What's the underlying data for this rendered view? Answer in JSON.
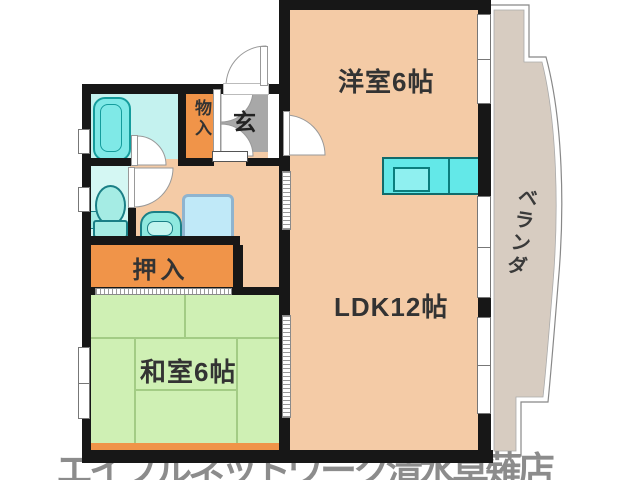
{
  "floorplan": {
    "title": "apartment-floor-plan",
    "rooms": {
      "western_room": {
        "label": "洋室6帖"
      },
      "ldk": {
        "label": "LDK12帖"
      },
      "japanese_room": {
        "label": "和室6帖"
      },
      "closet": {
        "label": "押入"
      },
      "storage": {
        "label": "物入"
      },
      "entrance": {
        "label": "玄"
      },
      "veranda": {
        "label": "ベランダ"
      }
    },
    "fixtures": [
      "bathtub",
      "toilet",
      "washbasin",
      "washing-machine",
      "kitchen-counter"
    ],
    "watermark": {
      "text": "エイブルネットワーク清水草薙店",
      "color": "#8c8c8c"
    },
    "colors": {
      "floor_peach": "#f4cba6",
      "tatami_green": "#cff0b4",
      "closet_orange": "#f09449",
      "fixture_cyan": "#7fe9e7",
      "kitchen_cyan": "#63e8e8",
      "entrance_gray": "#a8a8a8",
      "veranda_beige": "#d7ccc1",
      "wall_black": "#171717"
    }
  }
}
